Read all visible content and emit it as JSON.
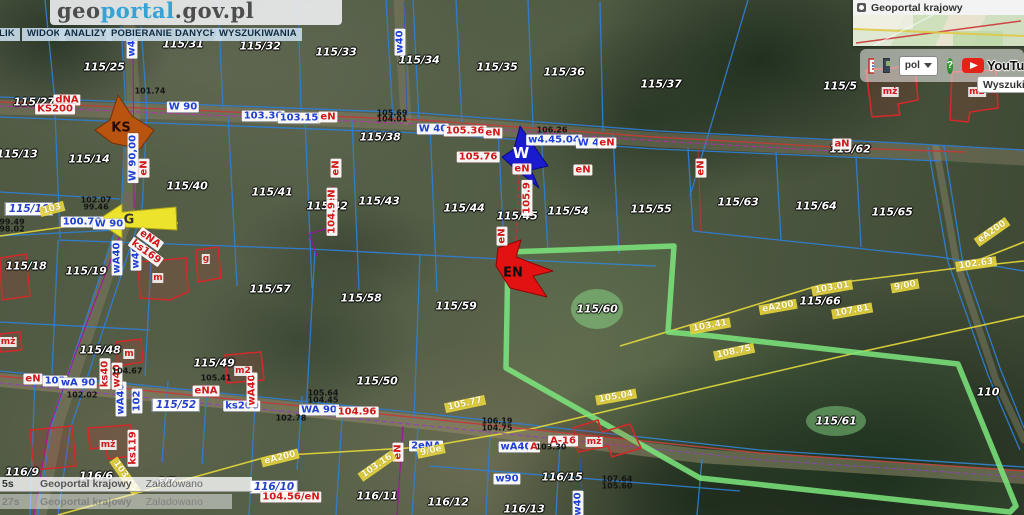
{
  "header": {
    "logo_geo": "geo",
    "logo_portal": "portal",
    "logo_suffix": ".gov.pl",
    "menu": [
      "LIK",
      "WIDOK",
      "ANALIZY",
      "POBIERANIE DANYCH",
      "WYSZUKIWANIA"
    ]
  },
  "overview_panel": {
    "title": "Geoportal krajowy",
    "language": "pol",
    "help": "?",
    "youtube": "YouTu",
    "search_button": "Wyszukiw"
  },
  "statusbar": {
    "rows": [
      {
        "time": "5s",
        "source": "Geoportal krajowy",
        "status": "Załadowano"
      },
      {
        "time": "27s",
        "source": "Geoportal krajowy",
        "status": "Załadowano"
      }
    ]
  },
  "map": {
    "labels": [
      {
        "t": "115/31",
        "x": 183,
        "y": 44,
        "c": "p"
      },
      {
        "t": "115/32",
        "x": 260,
        "y": 46,
        "c": "p"
      },
      {
        "t": "115/25",
        "x": 104,
        "y": 67,
        "c": "p"
      },
      {
        "t": "115/33",
        "x": 336,
        "y": 52,
        "c": "p"
      },
      {
        "t": "115/34",
        "x": 419,
        "y": 60,
        "c": "p"
      },
      {
        "t": "115/35",
        "x": 497,
        "y": 67,
        "c": "p"
      },
      {
        "t": "115/36",
        "x": 564,
        "y": 72,
        "c": "p"
      },
      {
        "t": "115/37",
        "x": 661,
        "y": 84,
        "c": "p"
      },
      {
        "t": "115/5",
        "x": 840,
        "y": 86,
        "c": "p"
      },
      {
        "t": "115/27",
        "x": 34,
        "y": 102,
        "c": "p"
      },
      {
        "t": "115/13",
        "x": 17,
        "y": 154,
        "c": "p"
      },
      {
        "t": "115/14",
        "x": 89,
        "y": 159,
        "c": "p"
      },
      {
        "t": "115/38",
        "x": 380,
        "y": 137,
        "c": "p"
      },
      {
        "t": "115/62",
        "x": 850,
        "y": 149,
        "c": "p"
      },
      {
        "t": "115/40",
        "x": 187,
        "y": 186,
        "c": "p"
      },
      {
        "t": "115/41",
        "x": 272,
        "y": 192,
        "c": "p"
      },
      {
        "t": "115/42",
        "x": 327,
        "y": 206,
        "c": "p"
      },
      {
        "t": "115/43",
        "x": 379,
        "y": 201,
        "c": "p"
      },
      {
        "t": "115/44",
        "x": 464,
        "y": 208,
        "c": "p"
      },
      {
        "t": "115/45",
        "x": 517,
        "y": 216,
        "c": "p"
      },
      {
        "t": "115/54",
        "x": 568,
        "y": 211,
        "c": "p"
      },
      {
        "t": "115/55",
        "x": 651,
        "y": 209,
        "c": "p"
      },
      {
        "t": "115/63",
        "x": 738,
        "y": 202,
        "c": "p"
      },
      {
        "t": "115/64",
        "x": 816,
        "y": 206,
        "c": "p"
      },
      {
        "t": "115/65",
        "x": 892,
        "y": 212,
        "c": "p"
      },
      {
        "t": "115/18",
        "x": 26,
        "y": 266,
        "c": "p"
      },
      {
        "t": "115/19",
        "x": 86,
        "y": 271,
        "c": "p"
      },
      {
        "t": "115/57",
        "x": 270,
        "y": 289,
        "c": "p"
      },
      {
        "t": "115/58",
        "x": 361,
        "y": 298,
        "c": "p"
      },
      {
        "t": "115/59",
        "x": 456,
        "y": 306,
        "c": "p"
      },
      {
        "t": "115/60",
        "x": 597,
        "y": 309,
        "c": "p"
      },
      {
        "t": "115/66",
        "x": 820,
        "y": 301,
        "c": "p"
      },
      {
        "t": "115/48",
        "x": 100,
        "y": 350,
        "c": "p"
      },
      {
        "t": "115/49",
        "x": 214,
        "y": 363,
        "c": "p"
      },
      {
        "t": "115/50",
        "x": 377,
        "y": 381,
        "c": "p"
      },
      {
        "t": "115/61",
        "x": 836,
        "y": 421,
        "c": "p"
      },
      {
        "t": "110",
        "x": 988,
        "y": 392,
        "c": "p"
      },
      {
        "t": "116/15",
        "x": 562,
        "y": 477,
        "c": "p"
      },
      {
        "t": "116/11",
        "x": 377,
        "y": 496,
        "c": "p"
      },
      {
        "t": "116/12",
        "x": 448,
        "y": 502,
        "c": "p"
      },
      {
        "t": "116/13",
        "x": 524,
        "y": 509,
        "c": "p"
      },
      {
        "t": "116/9",
        "x": 22,
        "y": 472,
        "c": "p",
        "z": 50
      },
      {
        "t": "116/6",
        "x": 96,
        "y": 476,
        "c": "p",
        "z": 50
      },
      {
        "t": "6/7",
        "x": 166,
        "y": 482,
        "c": "p",
        "z": 50
      },
      {
        "t": "115/10",
        "x": 29,
        "y": 209,
        "c": "pb"
      },
      {
        "t": "115/52",
        "x": 176,
        "y": 405,
        "c": "pb"
      },
      {
        "t": "116/10",
        "x": 274,
        "y": 487,
        "c": "pb"
      },
      {
        "t": "W 90",
        "x": 183,
        "y": 107,
        "c": "b"
      },
      {
        "t": "103.36",
        "x": 263,
        "y": 116,
        "c": "b"
      },
      {
        "t": "103.15",
        "x": 299,
        "y": 118,
        "c": "b"
      },
      {
        "t": "W 40",
        "x": 433,
        "y": 129,
        "c": "b"
      },
      {
        "t": "w4.45.04",
        "x": 554,
        "y": 140,
        "c": "b"
      },
      {
        "t": "W 40",
        "x": 592,
        "y": 143,
        "c": "b"
      },
      {
        "t": "100.76",
        "x": 82,
        "y": 222,
        "c": "b"
      },
      {
        "t": "W 90",
        "x": 109,
        "y": 224,
        "c": "b"
      },
      {
        "t": "103",
        "x": 55,
        "y": 381,
        "c": "b"
      },
      {
        "t": "wA 90",
        "x": 78,
        "y": 383,
        "c": "b"
      },
      {
        "t": "ks200",
        "x": 242,
        "y": 406,
        "c": "b"
      },
      {
        "t": "WA 90",
        "x": 319,
        "y": 410,
        "c": "b"
      },
      {
        "t": "w90",
        "x": 507,
        "y": 479,
        "c": "b"
      },
      {
        "t": "wA40",
        "x": 516,
        "y": 447,
        "c": "b"
      },
      {
        "t": "2eNA",
        "x": 426,
        "y": 446,
        "c": "b"
      },
      {
        "t": "W 90,00",
        "x": 133,
        "y": 158,
        "c": "bv",
        "r": -90
      },
      {
        "t": "w40",
        "x": 132,
        "y": 45,
        "c": "bv",
        "r": -90
      },
      {
        "t": "w40",
        "x": 400,
        "y": 42,
        "c": "bv",
        "r": -90
      },
      {
        "t": "wA40",
        "x": 117,
        "y": 258,
        "c": "bv",
        "r": -90
      },
      {
        "t": "w40",
        "x": 136,
        "y": 257,
        "c": "bv",
        "r": -90
      },
      {
        "t": "wA40",
        "x": 121,
        "y": 399,
        "c": "bv",
        "r": -90
      },
      {
        "t": "102",
        "x": 137,
        "y": 401,
        "c": "bv",
        "r": -90
      },
      {
        "t": "w40",
        "x": 578,
        "y": 504,
        "c": "bv",
        "r": -90
      },
      {
        "t": "dNA",
        "x": 67,
        "y": 100,
        "c": "r"
      },
      {
        "t": "KS200",
        "x": 55,
        "y": 109,
        "c": "r"
      },
      {
        "t": "105.36",
        "x": 465,
        "y": 131,
        "c": "r"
      },
      {
        "t": "eN",
        "x": 493,
        "y": 133,
        "c": "r"
      },
      {
        "t": "eN",
        "x": 607,
        "y": 143,
        "c": "r"
      },
      {
        "t": "105.76",
        "x": 478,
        "y": 157,
        "c": "r"
      },
      {
        "t": "aN",
        "x": 842,
        "y": 144,
        "c": "r"
      },
      {
        "t": "eN",
        "x": 328,
        "y": 117,
        "c": "r"
      },
      {
        "t": "104.96",
        "x": 357,
        "y": 412,
        "c": "r"
      },
      {
        "t": "104.56/eN",
        "x": 291,
        "y": 497,
        "c": "r"
      },
      {
        "t": "A-16",
        "x": 563,
        "y": 441,
        "c": "r"
      },
      {
        "t": "eNA",
        "x": 206,
        "y": 391,
        "c": "r"
      },
      {
        "t": "eN",
        "x": 33,
        "y": 379,
        "c": "r"
      },
      {
        "t": "eN",
        "x": 522,
        "y": 169,
        "c": "r"
      },
      {
        "t": "eN",
        "x": 583,
        "y": 170,
        "c": "r"
      },
      {
        "t": "A",
        "x": 534,
        "y": 447,
        "c": "r"
      },
      {
        "t": "ks40",
        "x": 105,
        "y": 374,
        "c": "rv",
        "r": -90
      },
      {
        "t": "ks119",
        "x": 133,
        "y": 448,
        "c": "rv",
        "r": -90
      },
      {
        "t": "eN",
        "x": 701,
        "y": 168,
        "c": "rv",
        "r": -90
      },
      {
        "t": "eN",
        "x": 144,
        "y": 168,
        "c": "rv",
        "r": -90
      },
      {
        "t": "eN",
        "x": 332,
        "y": 197,
        "c": "rv",
        "r": -90
      },
      {
        "t": "104.9",
        "x": 332,
        "y": 218,
        "c": "rv",
        "r": -90
      },
      {
        "t": "105.9",
        "x": 527,
        "y": 198,
        "c": "rv",
        "r": -90
      },
      {
        "t": "eN",
        "x": 502,
        "y": 236,
        "c": "rv",
        "r": -90
      },
      {
        "t": "w40",
        "x": 117,
        "y": 376,
        "c": "rv",
        "r": -90
      },
      {
        "t": "wA40",
        "x": 252,
        "y": 390,
        "c": "rv",
        "r": -90
      },
      {
        "t": "eN",
        "x": 398,
        "y": 452,
        "c": "rv",
        "r": -90
      },
      {
        "t": "ks169",
        "x": 146,
        "y": 252,
        "c": "rv",
        "r": 36
      },
      {
        "t": "eNA",
        "x": 150,
        "y": 239,
        "c": "rv",
        "r": 36
      },
      {
        "t": "eN",
        "x": 336,
        "y": 168,
        "c": "rv",
        "r": -90
      },
      {
        "t": "eA200",
        "x": 778,
        "y": 307,
        "c": "y",
        "r": -10
      },
      {
        "t": "103.01",
        "x": 832,
        "y": 288,
        "c": "y",
        "r": -10
      },
      {
        "t": "107.81",
        "x": 852,
        "y": 311,
        "c": "y",
        "r": -10
      },
      {
        "t": "9/00",
        "x": 905,
        "y": 286,
        "c": "y",
        "r": -10
      },
      {
        "t": "102.63",
        "x": 976,
        "y": 264,
        "c": "y",
        "r": -8
      },
      {
        "t": "eA200",
        "x": 992,
        "y": 232,
        "c": "y",
        "r": -35
      },
      {
        "t": "103.41",
        "x": 710,
        "y": 326,
        "c": "y",
        "r": -10
      },
      {
        "t": "eA200",
        "x": 280,
        "y": 458,
        "c": "y",
        "r": -14
      },
      {
        "t": "103.16",
        "x": 377,
        "y": 466,
        "c": "y",
        "r": -35
      },
      {
        "t": "105.77",
        "x": 465,
        "y": 404,
        "c": "y",
        "r": -12
      },
      {
        "t": "105.04",
        "x": 616,
        "y": 397,
        "c": "y",
        "r": -10
      },
      {
        "t": "108.75",
        "x": 734,
        "y": 352,
        "c": "y",
        "r": -12
      },
      {
        "t": "9/0e",
        "x": 431,
        "y": 451,
        "c": "y",
        "r": -12
      },
      {
        "t": "103.45",
        "x": 125,
        "y": 476,
        "c": "y",
        "r": 55
      },
      {
        "t": "103",
        "x": 52,
        "y": 209,
        "c": "y",
        "r": -15
      },
      {
        "t": "101.74",
        "x": 150,
        "y": 91,
        "c": "k"
      },
      {
        "t": "105.69",
        "x": 392,
        "y": 113,
        "c": "k"
      },
      {
        "t": "104.01",
        "x": 392,
        "y": 119,
        "c": "k"
      },
      {
        "t": "106.26",
        "x": 552,
        "y": 130,
        "c": "k"
      },
      {
        "t": "102.07",
        "x": 96,
        "y": 200,
        "c": "k"
      },
      {
        "t": "99.46",
        "x": 96,
        "y": 207,
        "c": "k"
      },
      {
        "t": "99.49",
        "x": 12,
        "y": 222,
        "c": "k"
      },
      {
        "t": "98.02",
        "x": 12,
        "y": 229,
        "c": "k"
      },
      {
        "t": "102.02",
        "x": 82,
        "y": 395,
        "c": "k"
      },
      {
        "t": "104.67",
        "x": 127,
        "y": 371,
        "c": "k"
      },
      {
        "t": "105.41",
        "x": 216,
        "y": 378,
        "c": "k"
      },
      {
        "t": "105.64",
        "x": 323,
        "y": 393,
        "c": "k"
      },
      {
        "t": "104.45",
        "x": 323,
        "y": 400,
        "c": "k"
      },
      {
        "t": "102.78",
        "x": 291,
        "y": 418,
        "c": "k"
      },
      {
        "t": "106.19",
        "x": 497,
        "y": 421,
        "c": "k"
      },
      {
        "t": "104.75",
        "x": 497,
        "y": 428,
        "c": "k"
      },
      {
        "t": "103.30",
        "x": 551,
        "y": 447,
        "c": "k"
      },
      {
        "t": "107.64",
        "x": 617,
        "y": 479,
        "c": "k"
      },
      {
        "t": "105.60",
        "x": 617,
        "y": 486,
        "c": "k"
      },
      {
        "t": "m",
        "x": 158,
        "y": 278,
        "c": "bl"
      },
      {
        "t": "g",
        "x": 206,
        "y": 259,
        "c": "bl"
      },
      {
        "t": "mż",
        "x": 890,
        "y": 92,
        "c": "bl"
      },
      {
        "t": "m2",
        "x": 977,
        "y": 92,
        "c": "bl"
      },
      {
        "t": "m",
        "x": 129,
        "y": 354,
        "c": "bl"
      },
      {
        "t": "m2",
        "x": 243,
        "y": 371,
        "c": "bl"
      },
      {
        "t": "mż",
        "x": 108,
        "y": 445,
        "c": "bl"
      },
      {
        "t": "mż",
        "x": 8,
        "y": 342,
        "c": "bl"
      },
      {
        "t": "mż",
        "x": 594,
        "y": 442,
        "c": "bl"
      }
    ],
    "flags": [
      {
        "t": "KS",
        "x": 121,
        "y": 128,
        "cls": "flag-ks",
        "name": "ks-marker-label"
      },
      {
        "t": "G",
        "x": 129,
        "y": 220,
        "cls": "flag-g",
        "name": "g-marker-label"
      },
      {
        "t": "W",
        "x": 521,
        "y": 153,
        "cls": "flag-w",
        "name": "w-marker-label"
      },
      {
        "t": "EN",
        "x": 513,
        "y": 273,
        "cls": "flag-en",
        "name": "en-marker-label"
      }
    ]
  }
}
